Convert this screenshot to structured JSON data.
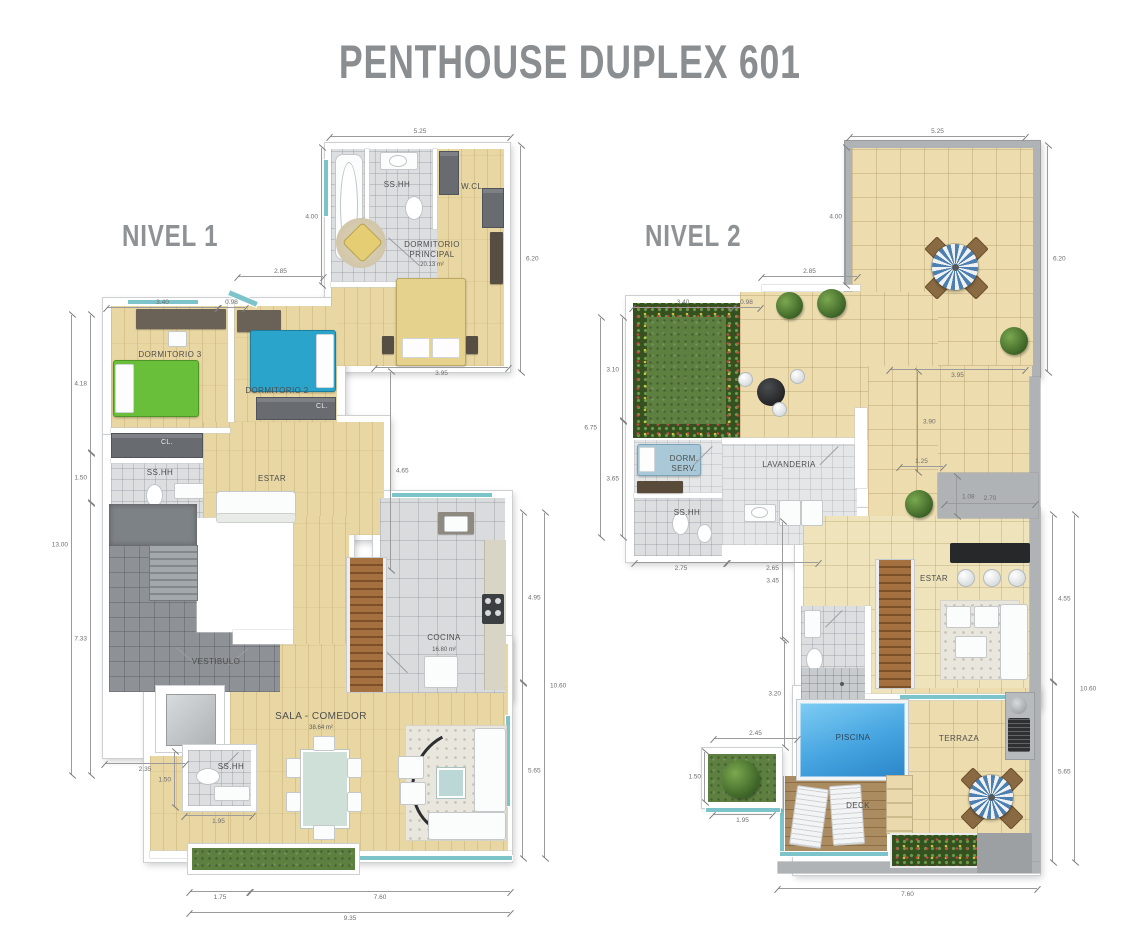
{
  "title": "PENTHOUSE DUPLEX 601",
  "colors": {
    "title": "#8b8e91",
    "wood": "#e8d7a2",
    "tile_cream": "#ecdcae",
    "pool": "#46a4e0",
    "grass": "#5d8040",
    "teal": "#7cc4ca",
    "bed_green": "#69bf3a",
    "bed_blue": "#2aa4ca",
    "bed_yellow": "#e5d28c",
    "wall_gray": "#b0b3b5"
  },
  "level1": {
    "label": "NIVEL 1",
    "rooms": {
      "ssh_master": "SS.HH",
      "wcl": "W.CL.",
      "master": "DORMITORIO PRINCIPAL",
      "master_area": "20.13 m²",
      "dorm3": "DORMITORIO 3",
      "dorm2": "DORMITORIO 2",
      "cl_d2": "CL.",
      "cl_d3": "CL.",
      "ssh_hall": "SS.HH",
      "estar": "ESTAR",
      "vestibulo": "VESTIBULO",
      "cocina": "COCINA",
      "cocina_area": "16.80 m²",
      "sala": "SALA - COMEDOR",
      "sala_area": "38.64 m²",
      "ssh_social": "SS.HH"
    },
    "dims": {
      "top": "5.25",
      "bath_h": "4.00",
      "suite_h": "6.20",
      "d2_top": "2.85",
      "d3_top": "3.40",
      "bay": "0.98",
      "left_a": "4.18",
      "left_b": "1.50",
      "left_c": "7.33",
      "left_total": "13.00",
      "mid_w": "3.95",
      "mid_h": "4.65",
      "right_a": "4.95",
      "right_b": "5.65",
      "right_total": "10.60",
      "bl_w": "2.35",
      "bl_h": "1.50",
      "bl_w2": "1.95",
      "bot_a": "1.75",
      "bot_b": "7.60",
      "bot_total": "9.35"
    }
  },
  "level2": {
    "label": "NIVEL 2",
    "rooms": {
      "dorm_serv": "DORM. SERV.",
      "ssh": "SS.HH",
      "lavanderia": "LAVANDERIA",
      "estar": "ESTAR",
      "piscina": "PISCINA",
      "terraza": "TERRAZA",
      "deck": "DECK"
    },
    "dims": {
      "top": "5.25",
      "terr_h": "4.00",
      "right_top": "6.20",
      "mid_top": "2.85",
      "garden_top": "3.40",
      "bay": "0.98",
      "left_a": "3.10",
      "left_b": "3.65",
      "left_total": "6.75",
      "upper_w": "3.95",
      "upper_h": "3.90",
      "step_w": "1.25",
      "step_h": "1.08",
      "step_w2": "2.70",
      "serv_a": "2.75",
      "serv_b": "2.65",
      "est_h": "3.45",
      "pool_h": "3.20",
      "pool_w": "2.45",
      "pl_h": "1.50",
      "pl_w": "1.95",
      "right_a": "4.55",
      "right_b": "5.65",
      "right_total": "10.60",
      "bottom": "7.60"
    }
  }
}
